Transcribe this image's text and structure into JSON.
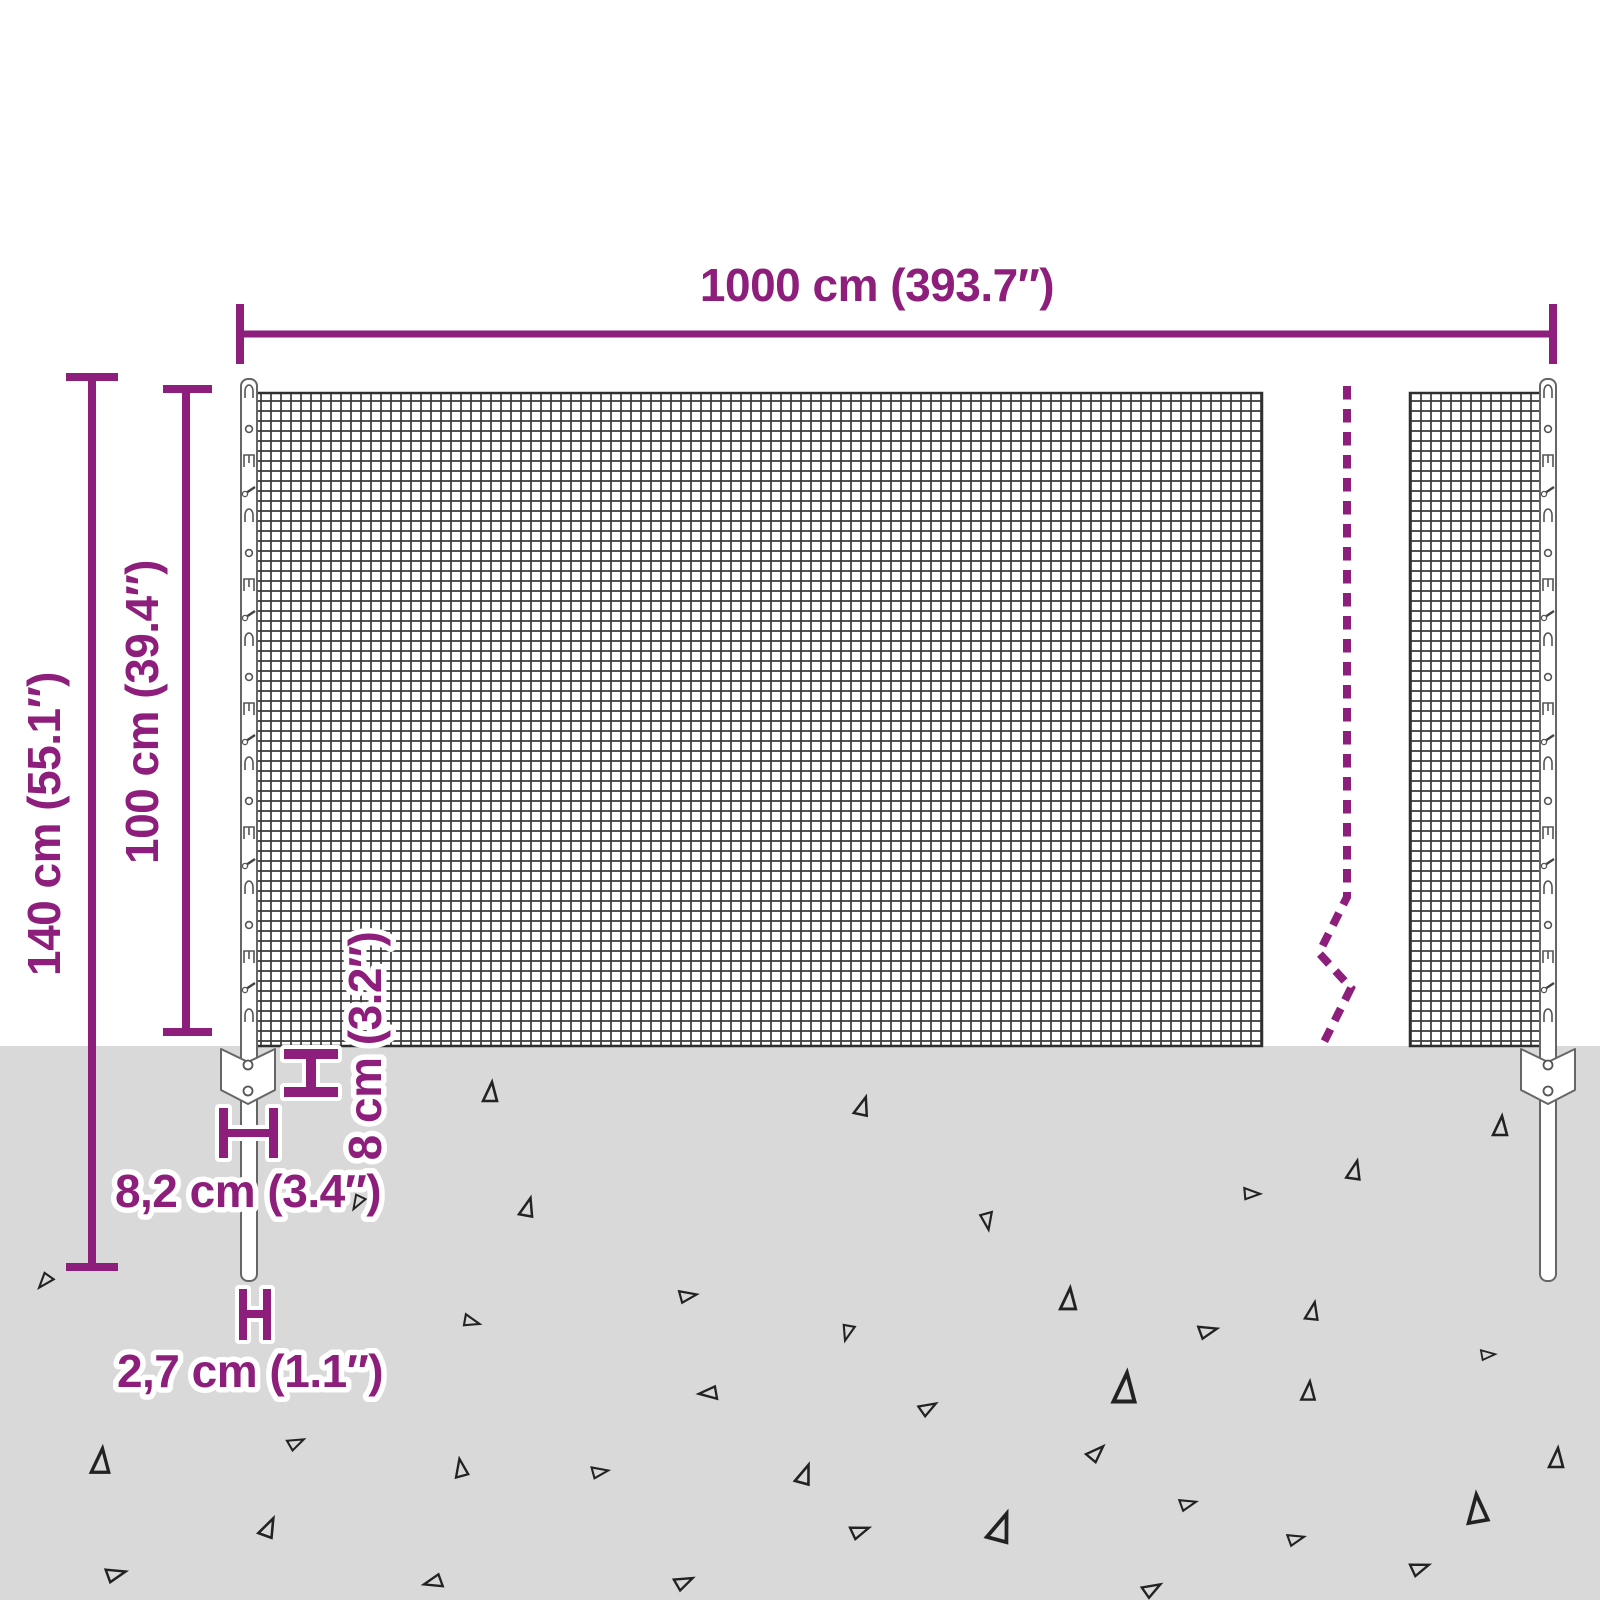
{
  "diagram_type": "fence-dimension-diagram",
  "colors": {
    "accent": "#8e1e7b",
    "ground": "#d9d9d9",
    "mesh": "#3a3a3a",
    "mesh_edge": "#2f2f2f",
    "post_outline": "#666666",
    "triangle": "#222222"
  },
  "labels": {
    "total_width": "1000 cm (393.7″)",
    "total_height": "140 cm (55.1″)",
    "mesh_height": "100 cm (39.4″)",
    "anchor_offset": "8 cm (3.2″)",
    "bracket_width": "8,2 cm (3.4″)",
    "post_diameter": "2,7 cm (1.1″)"
  }
}
